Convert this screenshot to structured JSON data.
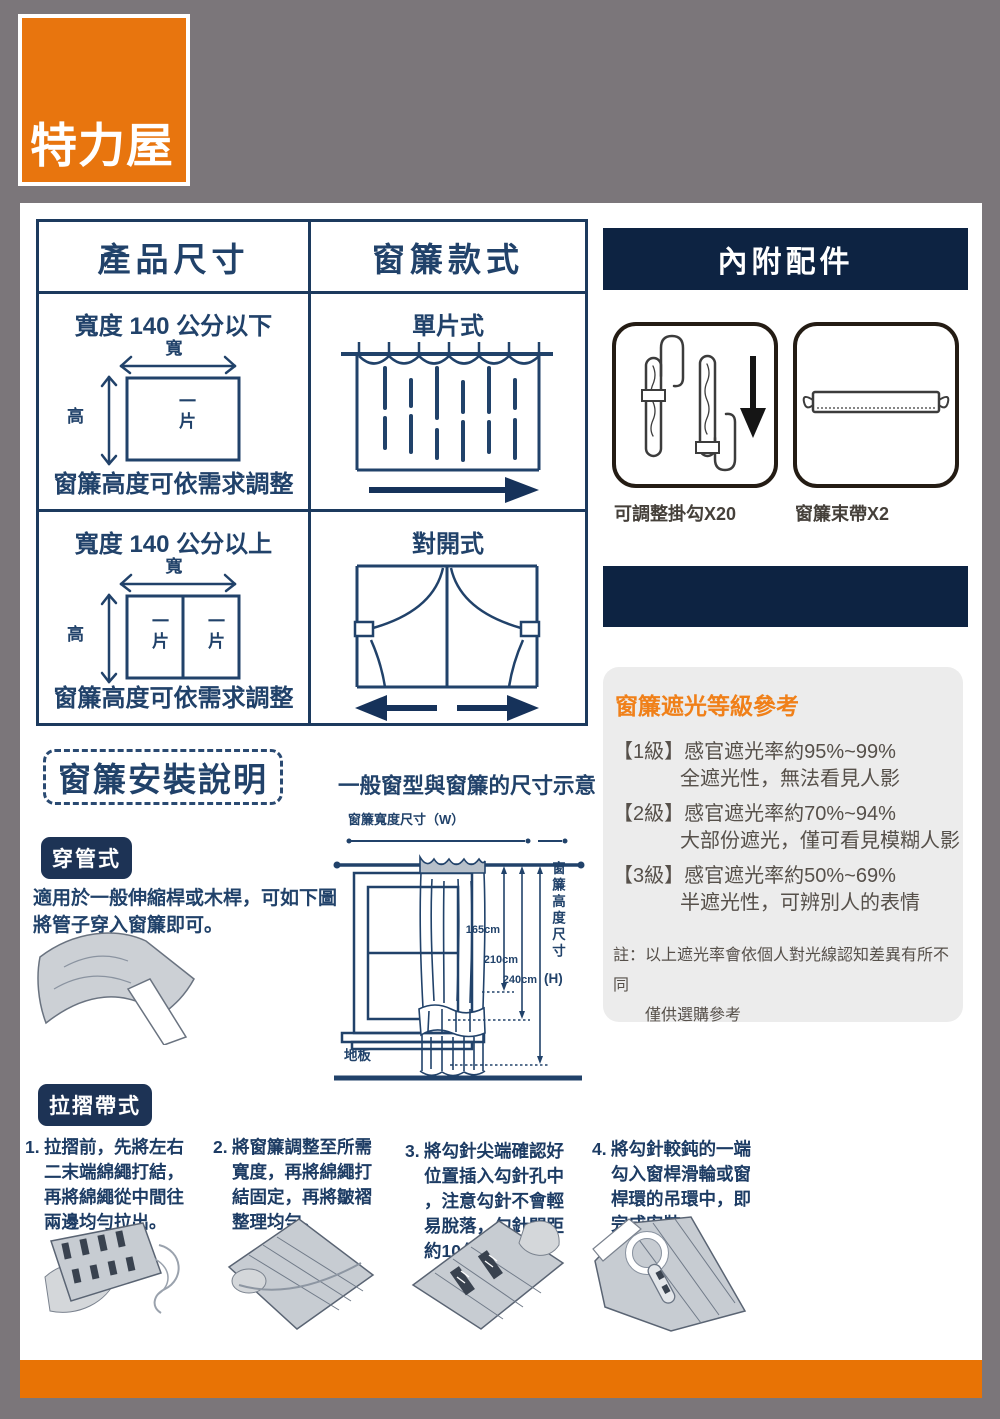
{
  "logo": {
    "text": "特力屋"
  },
  "size_table": {
    "header_left": "產品尺寸",
    "header_right": "窗簾款式",
    "row1": {
      "size_title": "寬度 140 公分以下",
      "width_label": "寬",
      "height_label": "高",
      "piece": "一片",
      "note": "窗簾高度可依需求調整",
      "style_title": "單片式"
    },
    "row2": {
      "size_title": "寬度 140 公分以上",
      "width_label": "寬",
      "height_label": "高",
      "piece_left": "一片",
      "piece_right": "一片",
      "note": "窗簾高度可依需求調整",
      "style_title": "對開式"
    }
  },
  "accessories": {
    "title": "內附配件",
    "hook_label": "可調整掛勾X20",
    "tie_label": "窗簾束帶X2"
  },
  "shading": {
    "title": "窗簾遮光等級參考",
    "levels": [
      {
        "grade": "【1級】",
        "rate": "感官遮光率約95%~99%",
        "desc": "全遮光性，無法看見人影"
      },
      {
        "grade": "【2級】",
        "rate": "感官遮光率約70%~94%",
        "desc": "大部份遮光，僅可看見模糊人影"
      },
      {
        "grade": "【3級】",
        "rate": "感官遮光率約50%~69%",
        "desc": "半遮光性，可辨別人的表情"
      }
    ],
    "note1": "註：以上遮光率會依個人對光線認知差異有所不同",
    "note2": "僅供選購參考"
  },
  "install": {
    "title": "窗簾安裝說明",
    "diagram_title": "一般窗型與窗簾的尺寸示意",
    "width_dim_label": "窗簾寬度尺寸（W）",
    "height_dim_label": "窗簾高度尺寸",
    "height_dim_suffix": "(H)",
    "floor_label": "地板",
    "dim_165": "165cm",
    "dim_210": "210cm",
    "dim_240": "240cm",
    "rod_method": {
      "badge": "穿管式",
      "desc": "適用於一般伸縮桿或木桿，可如下圖\n將管子穿入窗簾即可。"
    },
    "pleat_method": {
      "badge": "拉摺帶式",
      "steps": [
        {
          "no": "1.",
          "text": "拉摺前，先將左右二末端綿繩打結，再將綿繩從中間往兩邊均勻拉出。"
        },
        {
          "no": "2.",
          "text": "將窗簾調整至所需寬度，再將綿繩打結固定，再將皺褶整理均勻。"
        },
        {
          "no": "3.",
          "text": "將勾針尖端確認好位置插入勾針孔中，注意勾針不會輕易脫落，勾針間距約10公分。"
        },
        {
          "no": "4.",
          "text": "將勾針較鈍的一端勾入窗桿滑輪或窗桿環的吊環中，即完成安裝。"
        }
      ]
    }
  }
}
